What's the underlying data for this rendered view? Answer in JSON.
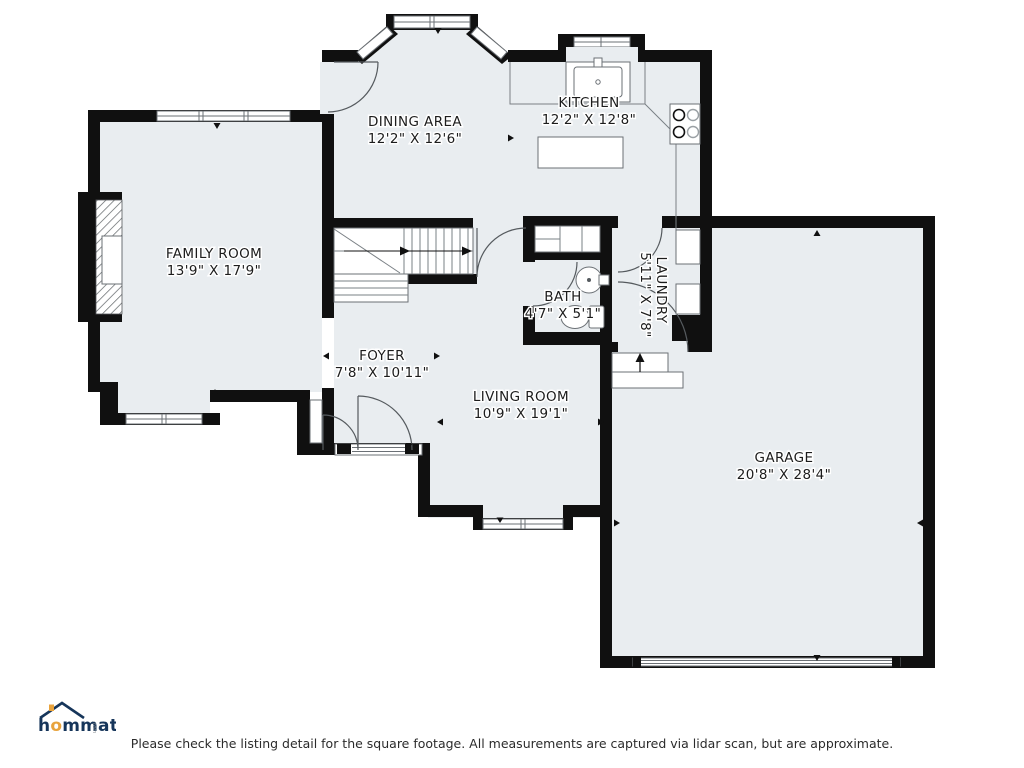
{
  "rooms": {
    "family": {
      "name": "FAMILY ROOM",
      "dims": "13'9\" X 17'9\""
    },
    "dining": {
      "name": "DINING AREA",
      "dims": "12'2\" X 12'6\""
    },
    "kitchen": {
      "name": "KITCHEN",
      "dims": "12'2\" X 12'8\""
    },
    "foyer": {
      "name": "FOYER",
      "dims": "7'8\" X 10'11\""
    },
    "bath": {
      "name": "BATH",
      "dims": "4'7\" X 5'1\""
    },
    "laundry": {
      "name": "LAUNDRY",
      "dims": "5'11\" X 7'8\""
    },
    "living": {
      "name": "LIVING ROOM",
      "dims": "10'9\" X 19'1\""
    },
    "garage": {
      "name": "GARAGE",
      "dims": "20'8\" X 28'4\""
    }
  },
  "branding": {
    "logo_part1": "h",
    "logo_part2": "o",
    "logo_part3": "mmati",
    "logo_suffix": ".com"
  },
  "footer": {
    "disclaimer": "Please check the listing detail for the square footage. All measurements are captured via lidar scan, but are approximate."
  },
  "colors": {
    "floor_fill": "#e9edf0",
    "wall": "#101010",
    "logo_navy": "#16355a",
    "logo_orange": "#e8a33d"
  }
}
